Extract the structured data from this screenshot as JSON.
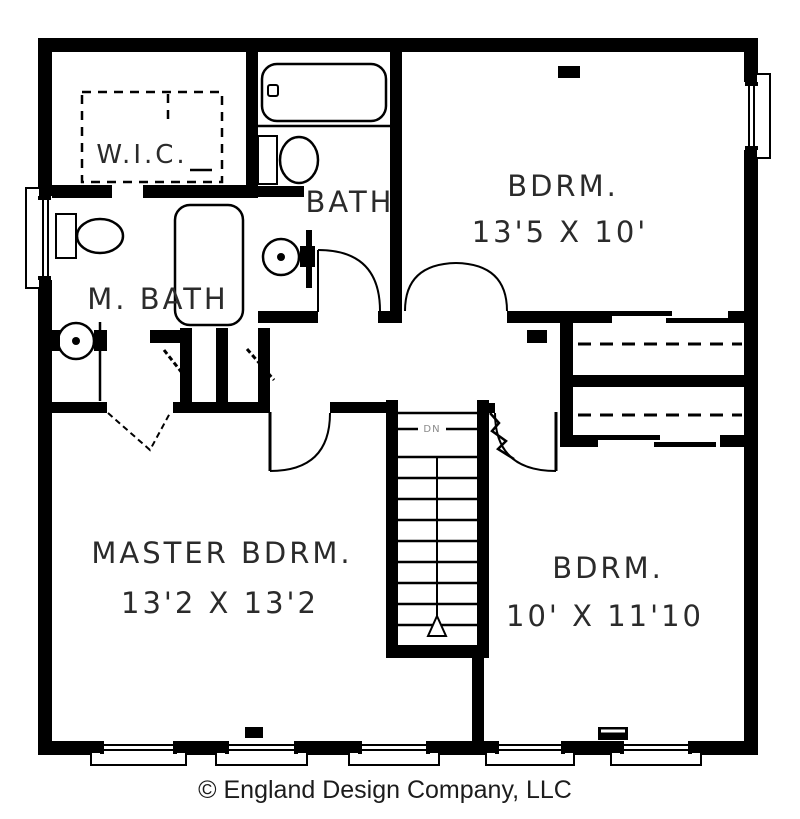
{
  "plan": {
    "rooms": {
      "wic": {
        "label": "W.I.C."
      },
      "bath": {
        "label": "BATH"
      },
      "master_bath": {
        "label": "M. BATH"
      },
      "bedroom1": {
        "label": "BDRM.",
        "dims": "13'5 X 10'"
      },
      "master_bedroom": {
        "label": "MASTER BDRM.",
        "dims": "13'2 X 13'2"
      },
      "bedroom2": {
        "label": "BDRM.",
        "dims": "10' X 11'10"
      }
    },
    "stairs": {
      "direction_label": "DN"
    },
    "fixtures": [
      "bathtub-icon",
      "toilet-icon",
      "sink-icon",
      "shower-icon",
      "closet-rod",
      "stairs",
      "window",
      "door-swing",
      "vent-icon"
    ],
    "colors": {
      "wall": "#000000",
      "label_text": "#2b2b2b",
      "dn_text": "#8a8a8a",
      "background": "#ffffff"
    }
  },
  "footer": {
    "copyright": "© England Design Company, LLC"
  }
}
